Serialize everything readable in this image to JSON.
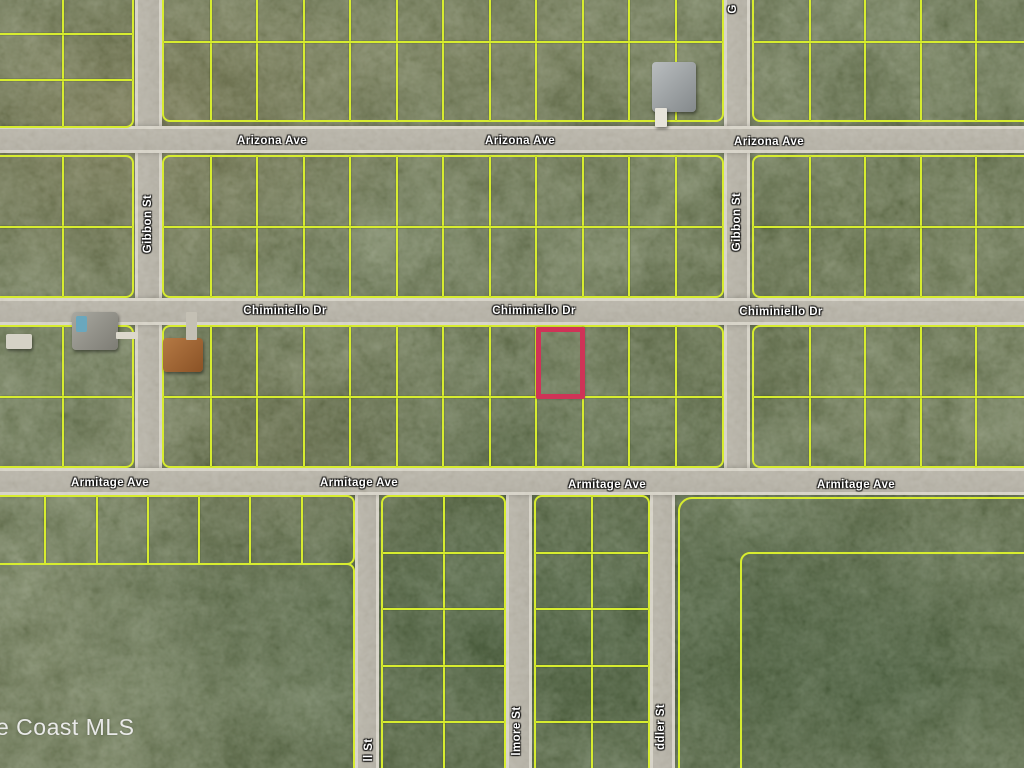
{
  "map": {
    "watermark": "e Coast MLS",
    "streets": {
      "arizona": "Arizona Ave",
      "chiminiello": "Chiminiello Dr",
      "armitage": "Armitage Ave",
      "gibbon": "Gibbon St",
      "gibbon_partial_top": "G",
      "ll_partial": "ll St",
      "lmore_partial": "lmore St",
      "ddler_partial": "ddler St"
    },
    "highlight": {
      "outline_color": "#cf3357"
    },
    "colors": {
      "parcel_line": "#d7ec2f",
      "road": "#b3afa3",
      "vegetation": "#434f2e",
      "label_text": "#ffffff",
      "watermark_text": "#efefef"
    }
  }
}
